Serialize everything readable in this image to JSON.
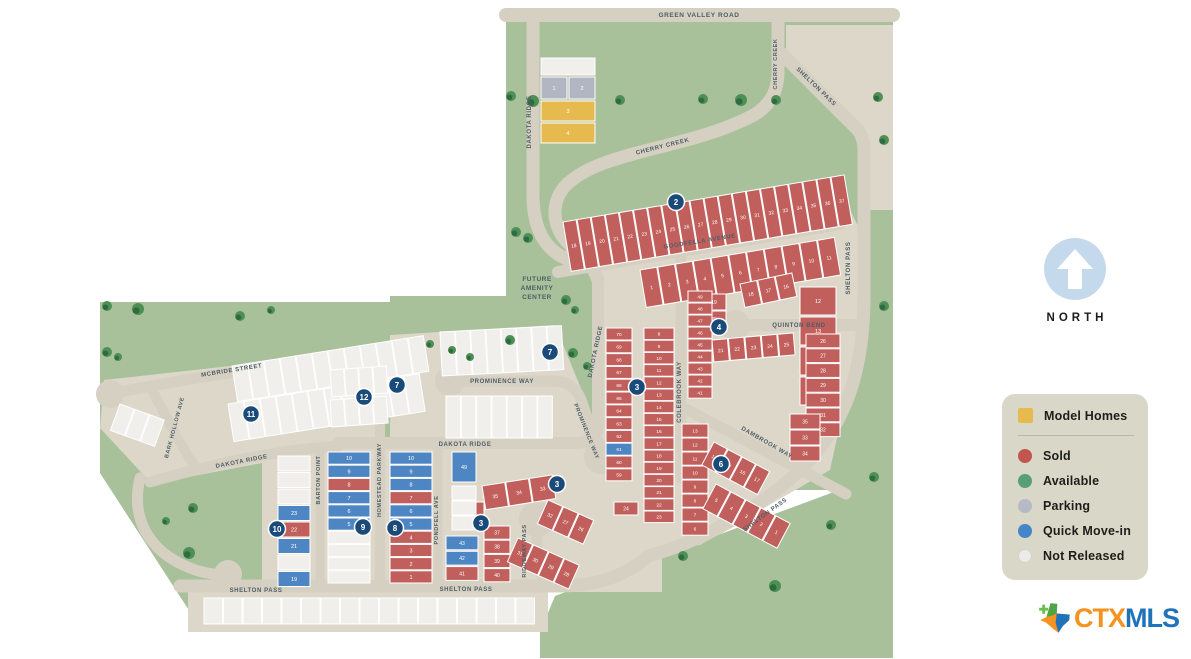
{
  "colors": {
    "sold": "#c05f5c",
    "quick": "#4e86c4",
    "parking": "#b2b6c3",
    "model": "#e7ba50",
    "not_released": "#f0efeb",
    "available": "#68a97f",
    "road": "#d6d0c2",
    "block": "#dcd7c9",
    "green": "#a8c19b",
    "tree_dark": "#2f6b42",
    "tree_light": "#4e8f54",
    "marker": "#1a4a7a",
    "street_text": "#4d5d66"
  },
  "legend": {
    "model_label": "Model Homes",
    "items": [
      {
        "label": "Sold",
        "color": "#c2564f"
      },
      {
        "label": "Available",
        "color": "#57a077"
      },
      {
        "label": "Parking",
        "color": "#b6bac7"
      },
      {
        "label": "Quick Move-in",
        "color": "#4586c7"
      },
      {
        "label": "Not Released",
        "color": "#ebebe9"
      }
    ]
  },
  "north_label": "NORTH",
  "logo": {
    "ctx": "CTX",
    "mls": "MLS"
  },
  "map": {
    "amenity_lines": [
      "FUTURE",
      "AMENITY",
      "CENTER"
    ],
    "streets": [
      {
        "t": "GREEN VALLEY ROAD",
        "x": 699,
        "y": 17,
        "r": 0,
        "fs": 6.5
      },
      {
        "t": "DAKOTA RIDGE",
        "x": 531,
        "y": 122,
        "r": -90,
        "fs": 6
      },
      {
        "t": "CHERRY CREEK",
        "x": 777,
        "y": 64,
        "r": -90,
        "fs": 5.5
      },
      {
        "t": "CHERRY CREEK",
        "x": 663,
        "y": 148,
        "r": -14,
        "fs": 6
      },
      {
        "t": "SHELTON PASS",
        "x": 815,
        "y": 88,
        "r": 44,
        "fs": 6
      },
      {
        "t": "GOODFELLA AVENUE",
        "x": 700,
        "y": 243,
        "r": -9,
        "fs": 6
      },
      {
        "t": "SHELTON PASS",
        "x": 850,
        "y": 268,
        "r": -90,
        "fs": 6
      },
      {
        "t": "DAKOTA RIDGE",
        "x": 597,
        "y": 352,
        "r": -78,
        "fs": 6
      },
      {
        "t": "QUINTON BEND",
        "x": 799,
        "y": 327,
        "r": 0,
        "fs": 6
      },
      {
        "t": "COLEBROOK WAY",
        "x": 681,
        "y": 392,
        "r": -90,
        "fs": 6
      },
      {
        "t": "DAMBROOK WAY",
        "x": 766,
        "y": 444,
        "r": 30,
        "fs": 6
      },
      {
        "t": "PROMINENCE WAY",
        "x": 502,
        "y": 383,
        "r": 0,
        "fs": 6
      },
      {
        "t": "PROMINENCE WAY",
        "x": 585,
        "y": 432,
        "r": 68,
        "fs": 5.5
      },
      {
        "t": "DAKOTA RIDGE",
        "x": 465,
        "y": 446,
        "r": 0,
        "fs": 6
      },
      {
        "t": "MCBRIDE STREET",
        "x": 232,
        "y": 372,
        "r": -9,
        "fs": 6
      },
      {
        "t": "BARK HOLLOW AVE",
        "x": 176,
        "y": 428,
        "r": -75,
        "fs": 5.5
      },
      {
        "t": "DAKOTA RIDGE",
        "x": 242,
        "y": 463,
        "r": -11,
        "fs": 6
      },
      {
        "t": "BARTON POINT",
        "x": 320,
        "y": 480,
        "r": -90,
        "fs": 5.5
      },
      {
        "t": "HOMESTEAD PARKWAY",
        "x": 381,
        "y": 480,
        "r": -90,
        "fs": 5.5
      },
      {
        "t": "PONDFELL AVE",
        "x": 438,
        "y": 520,
        "r": -90,
        "fs": 5.5
      },
      {
        "t": "RIDGEWAY PASS",
        "x": 526,
        "y": 551,
        "r": -90,
        "fs": 5.5
      },
      {
        "t": "SHELTON PASS",
        "x": 256,
        "y": 592,
        "r": 0,
        "fs": 6
      },
      {
        "t": "SHELTON PASS",
        "x": 466,
        "y": 591,
        "r": 0,
        "fs": 6
      },
      {
        "t": "SHELTON PASS",
        "x": 766,
        "y": 516,
        "r": -36,
        "fs": 6
      }
    ],
    "markers": [
      {
        "n": "2",
        "x": 676,
        "y": 202
      },
      {
        "n": "3",
        "x": 637,
        "y": 387
      },
      {
        "n": "4",
        "x": 719,
        "y": 327
      },
      {
        "n": "6",
        "x": 721,
        "y": 464
      },
      {
        "n": "7",
        "x": 550,
        "y": 352
      },
      {
        "n": "7",
        "x": 397,
        "y": 385
      },
      {
        "n": "3",
        "x": 557,
        "y": 484
      },
      {
        "n": "3",
        "x": 481,
        "y": 523
      },
      {
        "n": "8",
        "x": 395,
        "y": 528
      },
      {
        "n": "9",
        "x": 363,
        "y": 527
      },
      {
        "n": "10",
        "x": 277,
        "y": 529
      },
      {
        "n": "11",
        "x": 251,
        "y": 414
      },
      {
        "n": "12",
        "x": 364,
        "y": 397
      }
    ],
    "trees": [
      [
        511,
        96,
        5
      ],
      [
        533,
        101,
        6
      ],
      [
        620,
        100,
        5
      ],
      [
        703,
        99,
        5
      ],
      [
        741,
        100,
        6
      ],
      [
        776,
        100,
        5
      ],
      [
        878,
        97,
        5
      ],
      [
        884,
        140,
        5
      ],
      [
        516,
        232,
        5
      ],
      [
        528,
        238,
        5
      ],
      [
        566,
        300,
        5
      ],
      [
        575,
        310,
        4
      ],
      [
        510,
        340,
        5
      ],
      [
        573,
        353,
        5
      ],
      [
        587,
        366,
        4
      ],
      [
        107,
        306,
        5
      ],
      [
        138,
        309,
        6
      ],
      [
        240,
        316,
        5
      ],
      [
        271,
        310,
        4
      ],
      [
        107,
        352,
        5
      ],
      [
        118,
        357,
        4
      ],
      [
        193,
        508,
        5
      ],
      [
        166,
        521,
        4
      ],
      [
        189,
        553,
        6
      ],
      [
        430,
        344,
        4
      ],
      [
        452,
        350,
        4
      ],
      [
        470,
        357,
        4
      ],
      [
        683,
        556,
        5
      ],
      [
        775,
        586,
        6
      ],
      [
        831,
        525,
        5
      ],
      [
        874,
        477,
        5
      ],
      [
        884,
        306,
        5
      ]
    ],
    "groups": [
      {
        "x": 541,
        "y": 58,
        "r": 0,
        "dir": "col",
        "w": 54,
        "h": 17,
        "gap": 2,
        "fs": 5.5,
        "lots": "-n"
      },
      {
        "x": 541,
        "y": 77,
        "r": 0,
        "dir": "row",
        "w": 26,
        "h": 22,
        "gap": 2,
        "fs": 5.5,
        "lots": "1p 2p"
      },
      {
        "x": 541,
        "y": 101,
        "r": 0,
        "dir": "col",
        "w": 54,
        "h": 20,
        "gap": 2,
        "fs": 5.5,
        "lots": "3m 4m"
      },
      {
        "x": 563,
        "y": 222,
        "r": -9.5,
        "dir": "row",
        "w": 13.3,
        "h": 50,
        "gap": 1,
        "fs": 5,
        "lots": "18s 19s 20s 21s 22s 23s 24s 25s 26s 27s 28s 29s 30s 31s 32s 33s 34s 35s 36s 37s"
      },
      {
        "x": 640,
        "y": 270,
        "r": -9.5,
        "dir": "row",
        "w": 17,
        "h": 38,
        "gap": 1,
        "fs": 5,
        "lots": "1s 2s 3s 4s 5s 6s 7s 8s 9s 10s 11s"
      },
      {
        "x": 800,
        "y": 287,
        "r": 0,
        "dir": "col",
        "w": 36,
        "h": 28,
        "gap": 2,
        "fs": 5.5,
        "lots": "12s 13s 14s 15s"
      },
      {
        "x": 740,
        "y": 284,
        "r": -12,
        "dir": "row",
        "w": 17,
        "h": 24,
        "gap": 1,
        "fs": 5,
        "lots": "18s 17s 16s"
      },
      {
        "x": 702,
        "y": 294,
        "r": 0,
        "dir": "col",
        "w": 24,
        "h": 16,
        "gap": 1,
        "fs": 5,
        "lots": "19s 20s"
      },
      {
        "x": 712,
        "y": 340,
        "r": -5,
        "dir": "row",
        "w": 15.5,
        "h": 22,
        "gap": 1,
        "fs": 5,
        "lots": "21s 22s 23s 24s 25s"
      },
      {
        "x": 688,
        "y": 291,
        "r": 0,
        "dir": "col",
        "w": 24,
        "h": 11.2,
        "gap": 0.8,
        "fs": 4.8,
        "lots": "49s 48s 47s 46s 45s 44s 43s 42s 41s"
      },
      {
        "x": 806,
        "y": 334,
        "r": 0,
        "dir": "col",
        "w": 34,
        "h": 13.8,
        "gap": 1,
        "fs": 5,
        "lots": "26s 27s 28s 29s 30s 31s 32s"
      },
      {
        "x": 790,
        "y": 414,
        "r": 0,
        "dir": "col",
        "w": 30,
        "h": 15,
        "gap": 1,
        "fs": 5,
        "lots": "35s 33s 34s"
      },
      {
        "x": 682,
        "y": 424,
        "r": 0,
        "dir": "col",
        "w": 26,
        "h": 13.2,
        "gap": 0.8,
        "fs": 4.8,
        "lots": "13s 12s 11s 10s 9s 8s 7s 6s"
      },
      {
        "x": 714,
        "y": 442,
        "r": 28,
        "dir": "row",
        "w": 15,
        "h": 26,
        "gap": 1,
        "fs": 5,
        "lots": "14s 15s 16s 17s"
      },
      {
        "x": 716,
        "y": 484,
        "r": 28,
        "dir": "row",
        "w": 16,
        "h": 28,
        "gap": 1,
        "fs": 5,
        "lots": "5s 4s 3s 2s 1s"
      },
      {
        "x": 606,
        "y": 328,
        "r": 0,
        "dir": "col",
        "w": 26,
        "h": 12,
        "gap": 0.8,
        "fs": 4.8,
        "lots": "70s 69s 68s 67s 66s 65s 64s 63s 62s 61q 60s 59s"
      },
      {
        "x": 644,
        "y": 328,
        "r": 0,
        "dir": "col",
        "w": 30,
        "h": 11.6,
        "gap": 0.6,
        "fs": 4.8,
        "lots": "8s 9s 10s 11s 12s 13s 14s 15s 16s 17s 18s 19s 20s 21s 22s 23s"
      },
      {
        "x": 482,
        "y": 486,
        "r": -9,
        "dir": "row",
        "w": 23,
        "h": 24,
        "gap": 1,
        "fs": 5,
        "lots": "35s 34s 33s"
      },
      {
        "x": 458,
        "y": 502,
        "r": 0,
        "dir": "col",
        "w": 26,
        "h": 16,
        "gap": 1,
        "fs": 5,
        "lots": "36s"
      },
      {
        "x": 484,
        "y": 526,
        "r": 0,
        "dir": "col",
        "w": 26,
        "h": 13.2,
        "gap": 1,
        "fs": 5,
        "lots": "37s 38s 39s 40s"
      },
      {
        "x": 446,
        "y": 536,
        "r": 0,
        "dir": "col",
        "w": 32,
        "h": 13.8,
        "gap": 1.5,
        "fs": 5,
        "lots": "43q 42q 41s"
      },
      {
        "x": 548,
        "y": 500,
        "r": 24,
        "dir": "row",
        "w": 16,
        "h": 26,
        "gap": 1,
        "fs": 5,
        "lots": "32s 27s 26s"
      },
      {
        "x": 518,
        "y": 538,
        "r": 24,
        "dir": "row",
        "w": 16,
        "h": 26,
        "gap": 1,
        "fs": 5,
        "lots": "31s 30s 29s 28s"
      },
      {
        "x": 614,
        "y": 502,
        "r": 0,
        "dir": "col",
        "w": 24,
        "h": 13,
        "gap": 1,
        "fs": 5,
        "lots": "24s"
      },
      {
        "x": 278,
        "y": 456,
        "r": 0,
        "dir": "col",
        "w": 32,
        "h": 15,
        "gap": 1.5,
        "fs": 5.5,
        "lots": "-n -n -n 23q 22s 21q -n 19q"
      },
      {
        "x": 328,
        "y": 452,
        "r": 0,
        "dir": "col",
        "w": 42,
        "h": 12.2,
        "gap": 1,
        "fs": 5.5,
        "lots": "10q 9q 8s 7q 6q 5q -n -n -n -n"
      },
      {
        "x": 390,
        "y": 452,
        "r": 0,
        "dir": "col",
        "w": 42,
        "h": 12.2,
        "gap": 1,
        "fs": 5.5,
        "lots": "10q 9q 8q 7s 6q 5q 4s 3s 2s 1s"
      },
      {
        "x": 452,
        "y": 452,
        "r": 0,
        "dir": "col",
        "w": 24,
        "h": 30,
        "gap": 1,
        "fs": 5.5,
        "lots": "49q"
      },
      {
        "x": 452,
        "y": 486,
        "r": 0,
        "dir": "col",
        "w": 24,
        "h": 14,
        "gap": 1,
        "fs": 5,
        "lots": "-n -n -n"
      },
      {
        "x": 232,
        "y": 366,
        "r": -9,
        "dir": "row",
        "w": 15.4,
        "h": 36,
        "gap": 0.8,
        "fs": 5,
        "lots": "-n -n -n -n -n -n -n -n -n -n -n -n"
      },
      {
        "x": 228,
        "y": 404,
        "r": -9,
        "dir": "row",
        "w": 15.4,
        "h": 38,
        "gap": 0.8,
        "fs": 5,
        "lots": "-n -n -n -n -n -n -n -n -n -n -n -n"
      },
      {
        "x": 330,
        "y": 370,
        "r": -4,
        "dir": "row",
        "w": 13.5,
        "h": 27,
        "gap": 0.8,
        "fs": 5,
        "lots": "-n -n -n -n"
      },
      {
        "x": 330,
        "y": 400,
        "r": -4,
        "dir": "row",
        "w": 13.5,
        "h": 27,
        "gap": 0.8,
        "fs": 5,
        "lots": "-n -n -n -n"
      },
      {
        "x": 440,
        "y": 332,
        "r": -3,
        "dir": "row",
        "w": 14.5,
        "h": 44,
        "gap": 0.8,
        "fs": 5,
        "lots": "-n -n -n -n -n -n -n -n"
      },
      {
        "x": 446,
        "y": 396,
        "r": 0,
        "dir": "row",
        "w": 14.5,
        "h": 42,
        "gap": 0.8,
        "fs": 5,
        "lots": "-n -n -n -n -n -n -n"
      },
      {
        "x": 204,
        "y": 598,
        "r": 0,
        "dir": "row",
        "w": 18.5,
        "h": 26,
        "gap": 1,
        "fs": 5,
        "lots": "-n -n -n -n -n -n -n -n -n -n -n -n -n -n -n -n -n"
      },
      {
        "x": 120,
        "y": 404,
        "r": 20,
        "dir": "row",
        "w": 15,
        "h": 28,
        "gap": 1,
        "fs": 5,
        "lots": "-n -n -n"
      }
    ]
  }
}
